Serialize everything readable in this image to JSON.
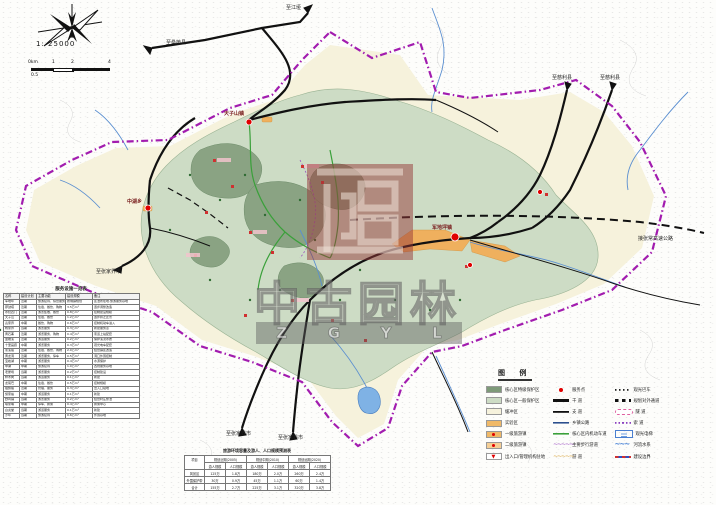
{
  "meta": {
    "scale_text": "1: 25000",
    "scale_ticks": [
      "0km",
      "1",
      "2",
      "4"
    ],
    "scale_half": "0.5"
  },
  "map_labels": {
    "to_sangzhi": "至桑植县",
    "to_jiangya": "至江垭",
    "to_cili_1": "至慈利县",
    "to_cili_2": "至慈利县",
    "to_zjj_left": "至张家界市",
    "to_zjj_bottom1": "至张家界市",
    "to_zjj_bottom2": "至张家界市",
    "expressway": "接张常高速公路",
    "tianzishan": "天子山镇",
    "zhonghu": "中湖乡",
    "jundiping": "军地坪镇"
  },
  "watermark": {
    "name": "中古园林",
    "letters": [
      "Z",
      "G",
      "Y",
      "L"
    ]
  },
  "legend": {
    "title": "图 例",
    "col1": [
      {
        "type": "sw sw-darkgreen",
        "label": "核心区特级保护区"
      },
      {
        "type": "sw sw-lightgreen",
        "label": "核心区一般保护区"
      },
      {
        "type": "sw sw-cream",
        "label": "缓冲区"
      },
      {
        "type": "sw sw-orange",
        "label": "实验区"
      },
      {
        "type": "sw sw-orange-dot",
        "label": "一级旅游镇"
      },
      {
        "type": "sw sw-orange-dot2",
        "label": "二级旅游镇"
      },
      {
        "type": "sw sw-entry",
        "label": "出入口/管理机构驻地"
      }
    ],
    "col2": [
      {
        "type": "ls ln-reddot",
        "label": "服务点"
      },
      {
        "type": "ls ln-thick",
        "label": "干  道"
      },
      {
        "type": "ls ln-mid",
        "label": "支  道"
      },
      {
        "type": "ls ln-blue",
        "label": "乡镇公路"
      },
      {
        "type": "ls ln-green",
        "label": "核心区内机动车道"
      },
      {
        "type": "ls ln-wavy-purple",
        "label": "主要步行游道"
      },
      {
        "type": "ls ln-wavy-orange",
        "label": "游  道"
      }
    ],
    "col3": [
      {
        "type": "ls ln-dot-black",
        "label": "观光巴车"
      },
      {
        "type": "ls ln-dash-sq",
        "label": "规划对外通道"
      },
      {
        "type": "ls ln-tunnel",
        "label": "隧  道"
      },
      {
        "type": "ls ln-dot-purple",
        "label": "索  道"
      },
      {
        "type": "ls ic-elevator",
        "label": "观光电梯"
      },
      {
        "type": "ls ln-wave-blue",
        "label": "河流水系"
      },
      {
        "type": "ls ln-redblue",
        "label": "建设边界"
      }
    ]
  },
  "facilities_table": {
    "title": "服务设施一览表",
    "headers": [
      "名称",
      "建设计划",
      "主要功能",
      "建设规模",
      "备注"
    ],
    "rows": [
      [
        "军地坪",
        "近期",
        "旅游接待、综合服务",
        "按城镇规划",
        "区治所在地,旅游服务基地"
      ],
      [
        "锣鼓塔",
        "近期",
        "住宿、餐饮、购物",
        "3.5万m²",
        "逐步调整改造"
      ],
      [
        "水绕四门",
        "近期",
        "游览集散、餐饮",
        "0.8万m²",
        "控制建设规模"
      ],
      [
        "天子山",
        "近期",
        "住宿、餐饮",
        "1.2万m²",
        "逐步拆迁还景"
      ],
      [
        "袁家界",
        "中期",
        "餐饮、购物",
        "0.6万m²",
        "控制机动车进入"
      ],
      [
        "杨家界",
        "远期",
        "游览服务",
        "0.3万m²",
        "新建服务点"
      ],
      [
        "黄石寨",
        "近期",
        "游览服务、购物",
        "0.4万m²",
        "索道上站配套"
      ],
      [
        "金鞭溪",
        "近期",
        "游道服务",
        "0.2万m²",
        "保护溪流水质"
      ],
      [
        "十里画廊",
        "中期",
        "游览服务",
        "0.3万m²",
        "观光电车配套"
      ],
      [
        "索溪峪",
        "近期",
        "住宿、餐饮、购物",
        "2.0万m²",
        "结合镇区改造"
      ],
      [
        "黄龙洞",
        "近期",
        "游览服务、停车",
        "0.5万m²",
        "洞口外围控制"
      ],
      [
        "宝峰湖",
        "中期",
        "游览服务",
        "0.4万m²",
        "水源保护"
      ],
      [
        "中湖",
        "中期",
        "旅游接待",
        "1.0万m²",
        "西线服务基地"
      ],
      [
        "老屋场",
        "远期",
        "游览服务",
        "0.2万m²",
        "控制建设"
      ],
      [
        "梓木岗",
        "远期",
        "游道服务",
        "0.1万m²",
        "新建"
      ],
      [
        "龙尾巴",
        "中期",
        "住宿、餐饮",
        "0.5万m²",
        "控制规模"
      ],
      [
        "插旗峪",
        "近期",
        "管理、服务",
        "0.3万m²",
        "出入口驻地"
      ],
      [
        "施家峪",
        "中期",
        "游道服务",
        "0.1万m²",
        "新建"
      ],
      [
        "野鸡铺",
        "远期",
        "游览服务",
        "0.2万m²",
        "结合村庄整治"
      ],
      [
        "喻家嘴",
        "中期",
        "停车、换乘",
        "0.4万m²",
        "换乘中心"
      ],
      [
        "白虎堂",
        "远期",
        "游道服务",
        "0.1万m²",
        "新建"
      ],
      [
        "沙坪",
        "远期",
        "旅游接待",
        "0.6万m²",
        "外围基地"
      ]
    ]
  },
  "capacity_table": {
    "title": "旅游环境容量及游人、人口规模预测表",
    "corner": "项目",
    "groups": [
      "规划近期(2005)",
      "规划中期(2010)",
      "规划远期(2020)"
    ],
    "subheaders": [
      "游人规模",
      "人口规模",
      "游人规模",
      "人口规模",
      "游人规模",
      "人口规模"
    ],
    "rows": [
      [
        "风景区",
        "125万",
        "1.8万",
        "180万",
        "2.0万",
        "260万",
        "2.4万"
      ],
      [
        "外围保护带",
        "30万",
        "0.9万",
        "45万",
        "1.1万",
        "60万",
        "1.4万"
      ],
      [
        "合计",
        "155万",
        "2.7万",
        "225万",
        "3.1万",
        "320万",
        "3.8万"
      ]
    ]
  }
}
